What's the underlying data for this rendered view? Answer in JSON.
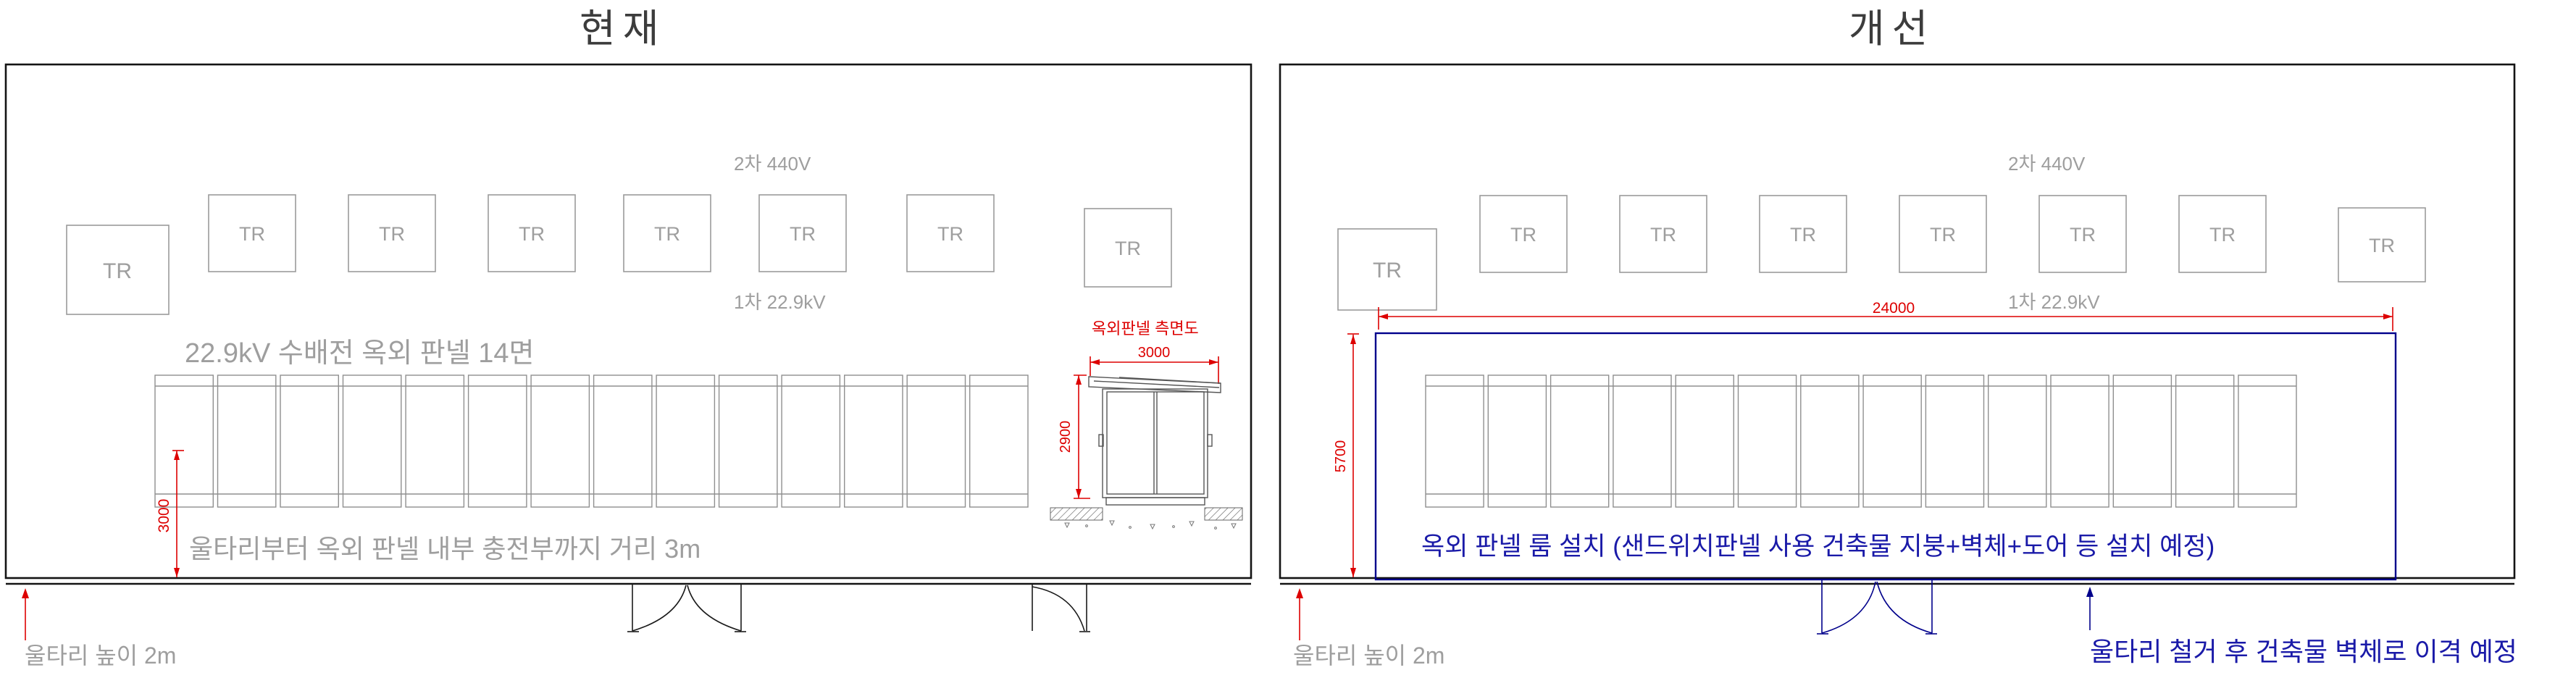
{
  "colors": {
    "line_black": "#141414",
    "line_gray": "#9b9b9b",
    "dim_red": "#dd0000",
    "plan_navy": "#00008b",
    "note_blue": "#1a1aa8",
    "text_gray": "#9e9e9e"
  },
  "left": {
    "title": "현재",
    "tr": "TR",
    "v2": "2차 440V",
    "v1": "1차 22.9kV",
    "row_title": "22.9kV 수배전 옥외 판넬 14면",
    "dim3000": "3000",
    "clearance": "울타리부터 옥외 판넬 내부 충전부까지 거리 3m",
    "fence": "울타리 높이 2m",
    "side": {
      "title": "옥외판넬 측면도",
      "w": "3000",
      "h": "2900"
    }
  },
  "right": {
    "title": "개선",
    "tr": "TR",
    "v2": "2차 440V",
    "v1": "1차 22.9kV",
    "dim24000": "24000",
    "dim5700": "5700",
    "room": "옥외 판넬 룸 설치 (샌드위치판넬 사용 건축물 지붕+벽체+도어 등 설치 예정)",
    "fence": "울타리 높이 2m",
    "removal": "울타리 철거 후 건축물 벽체로 이격 예정"
  }
}
